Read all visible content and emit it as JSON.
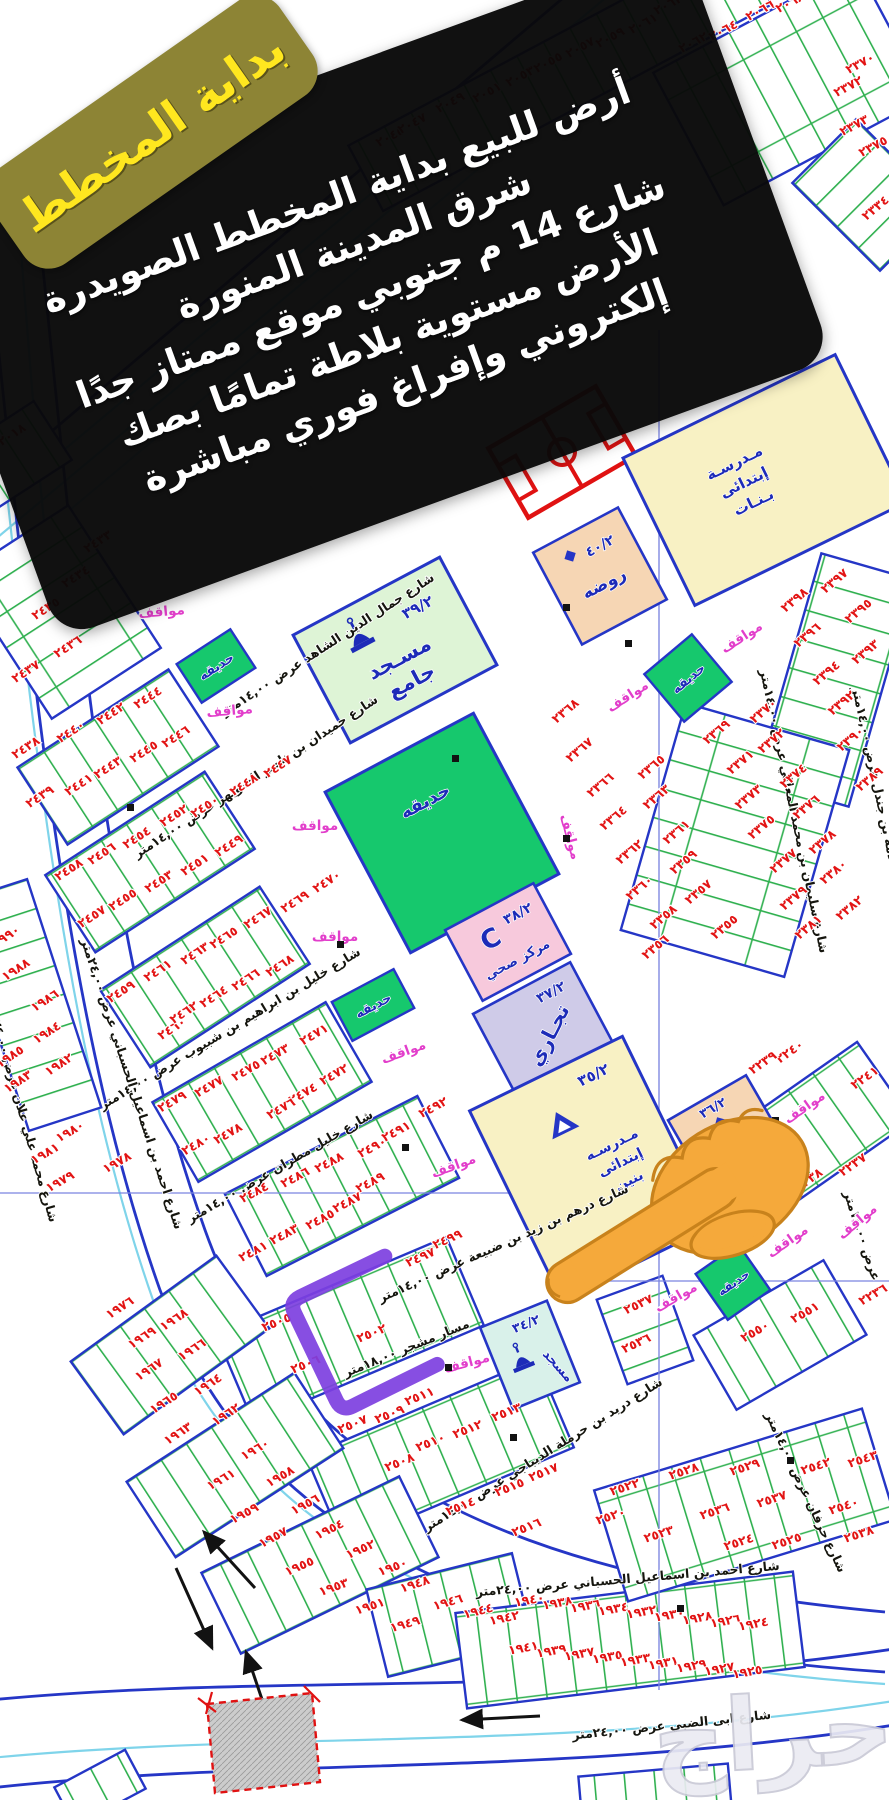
{
  "corner_badge": {
    "text": "بداية المخطط"
  },
  "ad_banner": {
    "lines": [
      "أرض للبيع بداية المخطط الصويدرة",
      "شرق المدينة المنورة",
      "شارع 14 م جنوبي موقع ممتاز جدًا",
      "الأرض مستوية بلاطة تمامًا بصك",
      "إلكتروني وإفراغ فوري مباشرة"
    ]
  },
  "landmarks": {
    "grand_mosque": {
      "name_line1": "مسـجد",
      "name_line2": "جامع",
      "code": "٣٩/٢"
    },
    "health_center": {
      "name": "مركز صحي",
      "code": "٣٨/٢",
      "letter": "C"
    },
    "commercial": {
      "name": "تجـاري",
      "code": "٣٧/٢"
    },
    "boys_school": {
      "name_line1": "مـدرسـه",
      "name_line2": "إبتدائى",
      "name_line3": "بنين",
      "code": "٣٥/٢"
    },
    "girls_school": {
      "name_line1": "مـدرسـة",
      "name_line2": "إبتدائى",
      "name_line3": "بـنـات"
    },
    "kindergarten_top": {
      "name": "روضه",
      "code": "٤٠/٢"
    },
    "kindergarten_right": {
      "name": "روضه",
      "code": "٣٦/٢"
    },
    "small_mosque": {
      "name": "مسجد",
      "code": "٣٤/٢"
    },
    "park_label": "حديقه",
    "parking_label": "مواقف"
  },
  "highlight": {
    "marked_plot": "٢٥٠٢"
  },
  "watermark": "حراج",
  "colors": {
    "plot_number_red": "#e21414",
    "block_border_blue": "#2536c6",
    "lot_line_green": "#2fb04f",
    "park_green": "#16c86d",
    "school_yellow": "#f8f1c4",
    "kindergarten_peach": "#f6d6b4",
    "mosque_green": "#def4d6",
    "small_mosque_cyan": "#d9f1ea",
    "health_pink": "#f7c9dc",
    "commercial_lavender": "#cfcbe8",
    "parking_magenta": "#e23ecb",
    "highlight_purple": "#7d3fe0",
    "badge_gold": "#8d8435",
    "badge_text_yellow": "#ffe71f",
    "banner_black": "#0a0a0a",
    "field_red": "#e01212"
  },
  "streets": [
    {
      "name": "شارع جمال الدين الشاهد عرض ١٤,٠٠متر",
      "x": 330,
      "y": 648,
      "r": -33,
      "fs": 12.5
    },
    {
      "name": "شارع حميدان بن ناصر الشويهر عرض ١٤,٠٠متر",
      "x": 258,
      "y": 780,
      "r": -33,
      "fs": 12.5
    },
    {
      "name": "شارع خليل بن ابراهيم بن شبيوب عرض ١٤,٠٠متر",
      "x": 232,
      "y": 1032,
      "r": -31,
      "fs": 12.5
    },
    {
      "name": "شارع خليل مطران عرض ١٤,٠٠متر",
      "x": 282,
      "y": 1170,
      "r": -30,
      "fs": 12.5
    },
    {
      "name": "شارع درهم بن زيد بن ضبيعة عرض ١٤,٠٠متر",
      "x": 505,
      "y": 1247,
      "r": -24,
      "fs": 12.5
    },
    {
      "name": "شارع احمد بن اسماعيل الحسباني عرض ٢٤,٠٠متر",
      "x": 128,
      "y": 1085,
      "r": 72,
      "fs": 12.5
    },
    {
      "name": "شارع احمد بن اسماعيل الحسباني عرض ٢٤,٠٠متر",
      "x": 628,
      "y": 1583,
      "r": -5,
      "fs": 14
    },
    {
      "name": "شارع ابى الضبي عرض ٢٤,٠٠متر",
      "x": 672,
      "y": 1729,
      "r": -6,
      "fs": 15
    },
    {
      "name": "شارع سليمان بن محمد المعللي عرض ١٤,٠٠متر",
      "x": 790,
      "y": 812,
      "r": 78,
      "fs": 11.5
    },
    {
      "name": "شارع سلامة بن جندل عرض ١٤,٠٠متر",
      "x": 876,
      "y": 800,
      "r": 78,
      "fs": 11.5
    },
    {
      "name": "شارع محمد علي علان عرض ٢٤,٠٠متر",
      "x": 18,
      "y": 1112,
      "r": 74,
      "fs": 11.5
    },
    {
      "name": "شارع دريد بن حرملة الديباجي عرض ١٤,٠٠متر",
      "x": 545,
      "y": 1458,
      "r": -32,
      "fs": 12
    },
    {
      "name": "شارع حرفان عرض ١٤,٠٠متر",
      "x": 802,
      "y": 1494,
      "r": 65,
      "fs": 11
    },
    {
      "name": "عرض ١٤,٠٠متر",
      "x": 858,
      "y": 1237,
      "r": 72,
      "fs": 10.5
    },
    {
      "name": "مسار مشجر ١٨,٠٠متر",
      "x": 408,
      "y": 1352,
      "r": -22,
      "fs": 10.5
    }
  ],
  "parking_spots": [
    [
      744,
      641,
      -33
    ],
    [
      630,
      700,
      -33
    ],
    [
      162,
      616,
      -5
    ],
    [
      230,
      715,
      -5
    ],
    [
      315,
      830,
      0
    ],
    [
      566,
      838,
      75
    ],
    [
      335,
      941,
      0
    ],
    [
      405,
      1056,
      -20
    ],
    [
      455,
      1170,
      -20
    ],
    [
      468,
      1367,
      -15
    ],
    [
      807,
      1111,
      -35
    ],
    [
      860,
      1225,
      -40
    ],
    [
      790,
      1245,
      -35
    ],
    [
      678,
      1301,
      -30
    ]
  ],
  "plot_numbers": [
    [
      "٢٠١٨",
      14,
      438,
      -33
    ],
    [
      "٢٠٤٥",
      392,
      140,
      -28
    ],
    [
      "٢٠٤٧",
      414,
      127,
      -28
    ],
    [
      "٢٠٤٩",
      452,
      106,
      -28
    ],
    [
      "٢٠٥١",
      489,
      96,
      -28
    ],
    [
      "٢٠٥٣",
      522,
      80,
      -28
    ],
    [
      "٢٠٥٥",
      550,
      66,
      -28
    ],
    [
      "٢٠٥٧",
      582,
      51,
      -28
    ],
    [
      "٢٠٥٩",
      612,
      41,
      -28
    ],
    [
      "٢٠٦١",
      645,
      27,
      -28
    ],
    [
      "٢٠٦٣",
      670,
      8,
      -28
    ],
    [
      "٢٠٦٢",
      695,
      46,
      -28
    ],
    [
      "٢٠٦٤",
      725,
      34,
      -28
    ],
    [
      "٢٠٦٦",
      762,
      14,
      -28
    ],
    [
      "٢٠٦٨",
      792,
      6,
      -28
    ],
    [
      "٢٣٧٠",
      862,
      67,
      -28
    ],
    [
      "٢٣٧٢",
      850,
      90,
      -28
    ],
    [
      "٢٣٧٣",
      856,
      129,
      -28
    ],
    [
      "٢٣٧٥",
      875,
      150,
      -28
    ],
    [
      "٢٣٣٤",
      878,
      211,
      -40
    ],
    [
      "٢٤٣٣",
      100,
      545,
      -33
    ],
    [
      "٢٤٣٤",
      78,
      580,
      -33
    ],
    [
      "٢٤٣٥",
      48,
      612,
      -33
    ],
    [
      "٢٤٣٦",
      70,
      650,
      -33
    ],
    [
      "٢٤٣٧",
      28,
      675,
      -33
    ],
    [
      "٢٤٤٤",
      150,
      701,
      -33
    ],
    [
      "٢٤٤٢",
      113,
      717,
      -33
    ],
    [
      "٢٤٤٠",
      73,
      735,
      -33
    ],
    [
      "٢٤٤٦",
      178,
      740,
      -33
    ],
    [
      "٢٤٣٨",
      28,
      751,
      -33
    ],
    [
      "٢٤٤٥",
      146,
      755,
      -33
    ],
    [
      "٢٤٤٣",
      110,
      771,
      -33
    ],
    [
      "٢٤٤١",
      81,
      788,
      -33
    ],
    [
      "٢٤٣٩",
      42,
      800,
      -33
    ],
    [
      "٢٤٤٧",
      280,
      770,
      -33
    ],
    [
      "٢٤٤٨",
      246,
      788,
      -33
    ],
    [
      "٢٤٥٠",
      207,
      810,
      -33
    ],
    [
      "٢٤٥٢",
      176,
      819,
      -33
    ],
    [
      "٢٤٥٤",
      139,
      841,
      -33
    ],
    [
      "٢٤٤٩",
      231,
      849,
      -33
    ],
    [
      "٢٤٥٦",
      104,
      857,
      -33
    ],
    [
      "٢٤٥١",
      197,
      868,
      -33
    ],
    [
      "٢٤٥٨",
      71,
      873,
      -33
    ],
    [
      "٢٤٥٣",
      161,
      885,
      -33
    ],
    [
      "٢٤٥٥",
      125,
      903,
      -33
    ],
    [
      "٢٤٥٧",
      94,
      920,
      -33
    ],
    [
      "٢٤٥٩",
      123,
      995,
      -33
    ],
    [
      "٢٤٦١",
      160,
      974,
      -33
    ],
    [
      "٢٤٦٣",
      197,
      957,
      -33
    ],
    [
      "٢٤٦٥",
      226,
      941,
      -33
    ],
    [
      "٢٤٦٧",
      260,
      921,
      -33
    ],
    [
      "٢٤٦٩",
      297,
      905,
      -33
    ],
    [
      "٢٤٦٠",
      174,
      1032,
      -33
    ],
    [
      "٢٤٦٢",
      186,
      1016,
      -33
    ],
    [
      "٢٤٦٤",
      216,
      1000,
      -33
    ],
    [
      "٢٤٦٦",
      248,
      983,
      -33
    ],
    [
      "٢٤٦٨",
      282,
      969,
      -33
    ],
    [
      "٢٤٧٠",
      329,
      885,
      -33
    ],
    [
      "١٩٩٠",
      8,
      940,
      -33
    ],
    [
      "١٩٨٨",
      18,
      973,
      -33
    ],
    [
      "١٩٨٦",
      47,
      1004,
      -33
    ],
    [
      "١٩٨٤",
      49,
      1036,
      -33
    ],
    [
      "١٩٨٥",
      12,
      1060,
      -33
    ],
    [
      "١٩٨٢",
      61,
      1068,
      -33
    ],
    [
      "١٩٨٣",
      20,
      1085,
      -33
    ],
    [
      "١٩٨٠",
      72,
      1135,
      -30
    ],
    [
      "١٩٨١",
      47,
      1157,
      -30
    ],
    [
      "١٩٧٨",
      119,
      1166,
      -30
    ],
    [
      "١٩٧٩",
      62,
      1185,
      -30
    ],
    [
      "٢٤٧٣",
      277,
      1058,
      -30
    ],
    [
      "٢٤٧١",
      316,
      1038,
      -30
    ],
    [
      "٢٤٧٥",
      248,
      1074,
      -30
    ],
    [
      "٢٤٧٢",
      336,
      1078,
      -30
    ],
    [
      "٢٤٧٧",
      211,
      1090,
      -30
    ],
    [
      "٢٤٧٤",
      305,
      1097,
      -30
    ],
    [
      "٢٤٧٩",
      174,
      1105,
      -30
    ],
    [
      "٢٤٧٦",
      283,
      1112,
      -30
    ],
    [
      "٢٤٧٨",
      230,
      1137,
      -30
    ],
    [
      "٢٤٨٠",
      198,
      1148,
      -30
    ],
    [
      "٢٤٩٢",
      435,
      1111,
      -28
    ],
    [
      "٢٤٩١",
      398,
      1135,
      -28
    ],
    [
      "٢٤٩٠",
      374,
      1151,
      -28
    ],
    [
      "٢٤٨٨",
      331,
      1166,
      -28
    ],
    [
      "٢٤٨٩",
      372,
      1186,
      -28
    ],
    [
      "٢٤٨٦",
      297,
      1181,
      -28
    ],
    [
      "٢٤٨٧",
      349,
      1206,
      -28
    ],
    [
      "٢٤٨٥",
      322,
      1223,
      -28
    ],
    [
      "٢٤٨٣",
      286,
      1238,
      -28
    ],
    [
      "٢٤٨١",
      255,
      1255,
      -28
    ],
    [
      "٢٤٨٤",
      256,
      1196,
      -28
    ],
    [
      "٢٤٩٧",
      422,
      1261,
      -24
    ],
    [
      "٢٤٩٩",
      449,
      1243,
      -24
    ],
    [
      "٢٥٠٥",
      278,
      1326,
      -22
    ],
    [
      "٢٥٠٢",
      373,
      1337,
      -22
    ],
    [
      "٢٥٠٦",
      307,
      1368,
      -22
    ],
    [
      "٢٥١١",
      421,
      1400,
      -22
    ],
    [
      "٢٥١٣",
      508,
      1416,
      -22
    ],
    [
      "٢٥٠٧",
      354,
      1428,
      -22
    ],
    [
      "٢٥٠٩",
      391,
      1418,
      -22
    ],
    [
      "٢٥١٢",
      469,
      1433,
      -22
    ],
    [
      "٢٥١٠",
      432,
      1446,
      -22
    ],
    [
      "٢٥٠٨",
      401,
      1466,
      -22
    ],
    [
      "٢٥١٥",
      511,
      1491,
      -22
    ],
    [
      "٢٥١٤",
      462,
      1510,
      -22
    ],
    [
      "٢٥١٦",
      528,
      1531,
      -22
    ],
    [
      "٢٥١٧",
      545,
      1476,
      -22
    ],
    [
      "١٩٧٦",
      122,
      1311,
      -33
    ],
    [
      "١٩٦٨",
      176,
      1323,
      -33
    ],
    [
      "١٩٦٩",
      144,
      1341,
      -33
    ],
    [
      "١٩٦٦",
      194,
      1353,
      -33
    ],
    [
      "١٩٦٧",
      151,
      1373,
      -33
    ],
    [
      "١٩٦٤",
      210,
      1388,
      -33
    ],
    [
      "١٩٦٥",
      166,
      1406,
      -33
    ],
    [
      "١٩٦٢",
      228,
      1418,
      -33
    ],
    [
      "١٩٦٣",
      180,
      1437,
      -33
    ],
    [
      "١٩٦٠",
      257,
      1453,
      -30
    ],
    [
      "١٩٦١",
      223,
      1483,
      -30
    ],
    [
      "١٩٥٨",
      282,
      1480,
      -30
    ],
    [
      "١٩٥٦",
      307,
      1508,
      -28
    ],
    [
      "١٩٥٩",
      246,
      1517,
      -28
    ],
    [
      "١٩٥٧",
      275,
      1541,
      -28
    ],
    [
      "١٩٥٤",
      331,
      1533,
      -26
    ],
    [
      "١٩٥٢",
      362,
      1553,
      -24
    ],
    [
      "١٩٥٥",
      301,
      1570,
      -24
    ],
    [
      "١٩٥٠",
      394,
      1571,
      -20
    ],
    [
      "١٩٥٣",
      335,
      1591,
      -20
    ],
    [
      "١٩٤٨",
      416,
      1588,
      -18
    ],
    [
      "١٩٥١",
      371,
      1610,
      -18
    ],
    [
      "١٩٤٦",
      449,
      1606,
      -16
    ],
    [
      "١٩٤٩",
      406,
      1628,
      -16
    ],
    [
      "١٩٤٤",
      479,
      1615,
      -14
    ],
    [
      "١٩٤٢",
      505,
      1622,
      -12
    ],
    [
      "١٩٤٠",
      530,
      1604,
      -10
    ],
    [
      "١٩٣٨",
      558,
      1607,
      -10
    ],
    [
      "١٩٣٦",
      586,
      1610,
      -10
    ],
    [
      "١٩٣٤",
      614,
      1613,
      -10
    ],
    [
      "١٩٣٢",
      642,
      1616,
      -10
    ],
    [
      "١٩٣٠",
      670,
      1619,
      -10
    ],
    [
      "١٩٢٨",
      698,
      1622,
      -10
    ],
    [
      "١٩٢٦",
      726,
      1625,
      -10
    ],
    [
      "١٩٢٤",
      754,
      1628,
      -10
    ],
    [
      "١٩٤١",
      524,
      1652,
      -10
    ],
    [
      "١٩٣٩",
      552,
      1655,
      -10
    ],
    [
      "١٩٣٧",
      580,
      1658,
      -10
    ],
    [
      "١٩٣٥",
      608,
      1661,
      -10
    ],
    [
      "١٩٣٣",
      636,
      1664,
      -10
    ],
    [
      "١٩٣١",
      664,
      1667,
      -10
    ],
    [
      "١٩٢٩",
      692,
      1670,
      -10
    ],
    [
      "١٩٢٧",
      720,
      1673,
      -10
    ],
    [
      "١٩٢٥",
      748,
      1676,
      -10
    ],
    [
      "٢٣٩٧",
      837,
      584,
      -40
    ],
    [
      "٢٣٩٨",
      797,
      603,
      -40
    ],
    [
      "٢٣٩٥",
      861,
      614,
      -40
    ],
    [
      "٢٣٩٦",
      810,
      638,
      -40
    ],
    [
      "٢٣٩٣",
      868,
      655,
      -40
    ],
    [
      "٢٣٩٤",
      829,
      676,
      -40
    ],
    [
      "٢٣٩٢",
      844,
      706,
      -40
    ],
    [
      "٢٣٩٠",
      853,
      742,
      -40
    ],
    [
      "٢٣٨٩",
      872,
      782,
      -40
    ],
    [
      "٢٣٦٨",
      568,
      714,
      -40
    ],
    [
      "٢٣٦٧",
      582,
      753,
      -40
    ],
    [
      "٢٣٧٠",
      766,
      714,
      -40
    ],
    [
      "٢٣٦٩",
      719,
      735,
      -40
    ],
    [
      "٢٣٧٢",
      774,
      744,
      -40
    ],
    [
      "٢٣٧١",
      743,
      765,
      -40
    ],
    [
      "٢٣٧٤",
      796,
      779,
      -40
    ],
    [
      "٢٣٧٣",
      751,
      800,
      -40
    ],
    [
      "٢٣٧٦",
      809,
      810,
      -40
    ],
    [
      "٢٣٧٥",
      764,
      830,
      -40
    ],
    [
      "٢٣٧٨",
      825,
      845,
      -40
    ],
    [
      "٢٣٧٧",
      786,
      864,
      -40
    ],
    [
      "٢٣٨٠",
      836,
      875,
      -40
    ],
    [
      "٢٣٧٩",
      796,
      901,
      -40
    ],
    [
      "٢٣٨٢",
      852,
      911,
      -40
    ],
    [
      "٢٣٨١",
      811,
      930,
      -40
    ],
    [
      "٢٣٦٥",
      654,
      770,
      -40
    ],
    [
      "٢٣٦٦",
      603,
      788,
      -40
    ],
    [
      "٢٣٦٣",
      659,
      800,
      -40
    ],
    [
      "٢٣٦٤",
      616,
      821,
      -40
    ],
    [
      "٢٣٦١",
      679,
      835,
      -40
    ],
    [
      "٢٣٦٢",
      632,
      855,
      -40
    ],
    [
      "٢٣٥٩",
      686,
      865,
      -40
    ],
    [
      "٢٣٦٠",
      642,
      891,
      -40
    ],
    [
      "٢٣٥٧",
      701,
      895,
      -40
    ],
    [
      "٢٣٥٨",
      666,
      920,
      -40
    ],
    [
      "٢٣٥٥",
      727,
      930,
      -40
    ],
    [
      "٢٣٥٦",
      658,
      950,
      -40
    ],
    [
      "٢٢٤٠",
      792,
      1055,
      -35
    ],
    [
      "٢٢٣٩",
      765,
      1066,
      -35
    ],
    [
      "٢٢٤١",
      867,
      1081,
      -35
    ],
    [
      "٢٢٣٧",
      855,
      1168,
      -35
    ],
    [
      "٢٢٣٨",
      811,
      1183,
      -35
    ],
    [
      "٢٢٣٦",
      875,
      1298,
      -30
    ],
    [
      "٢٥٥١",
      807,
      1316,
      -30
    ],
    [
      "٢٥٥٠",
      757,
      1335,
      -30
    ],
    [
      "٢٥٣٧",
      640,
      1308,
      -25
    ],
    [
      "٢٥٣٦",
      638,
      1347,
      -25
    ],
    [
      "٢٥٢٠",
      612,
      1520,
      -18
    ],
    [
      "٢٥٢٢",
      626,
      1491,
      -18
    ],
    [
      "٢٥٢٣",
      660,
      1538,
      -18
    ],
    [
      "٢٥٢٤",
      740,
      1546,
      -18
    ],
    [
      "٢٥٢٥",
      788,
      1545,
      -18
    ],
    [
      "٢٥٢٨",
      685,
      1475,
      -18
    ],
    [
      "٢٥٢٩",
      746,
      1471,
      -18
    ],
    [
      "٢٥٣٦",
      716,
      1515,
      -18
    ],
    [
      "٢٥٣٧",
      773,
      1503,
      -18
    ],
    [
      "٢٥٣٨",
      860,
      1538,
      -18
    ],
    [
      "٢٥٤٠",
      845,
      1510,
      -18
    ],
    [
      "٢٥٤٢",
      817,
      1470,
      -18
    ],
    [
      "٢٥٤٣",
      864,
      1463,
      -18
    ]
  ]
}
